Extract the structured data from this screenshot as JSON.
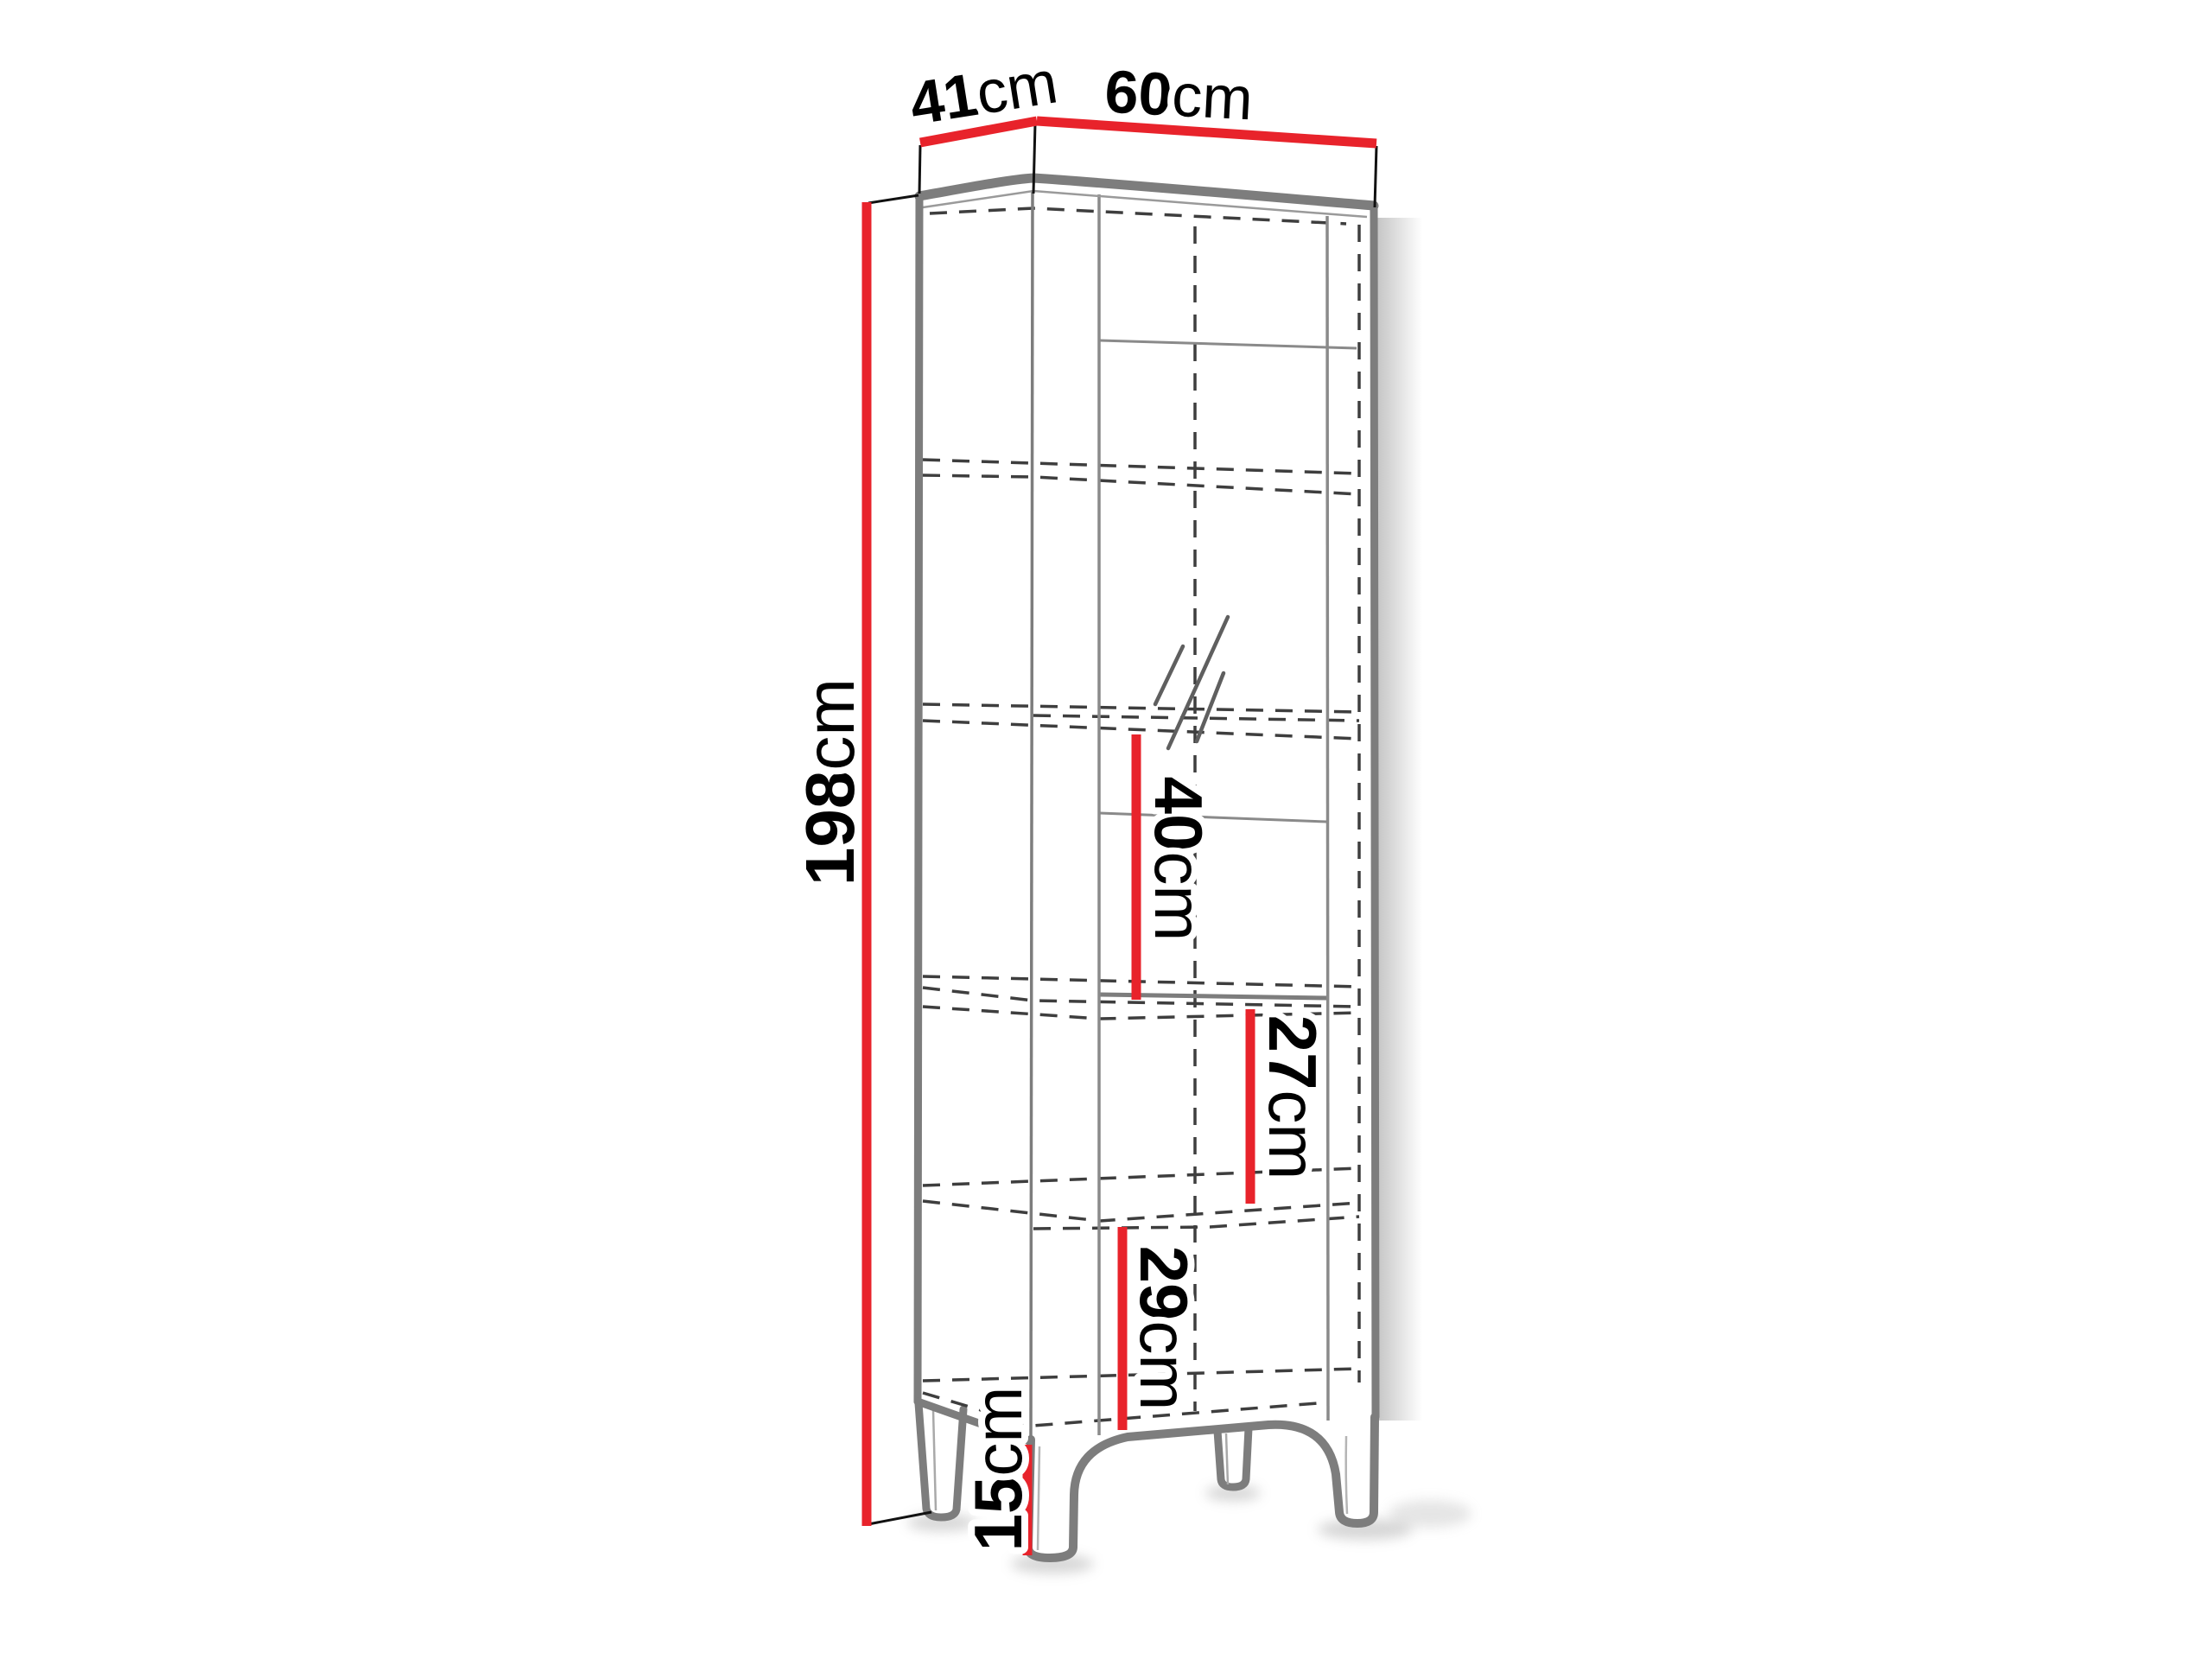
{
  "diagram": {
    "type": "furniture-dimension-diagram",
    "dimensions": {
      "depth": {
        "value": "41",
        "unit": "cm"
      },
      "width": {
        "value": "60",
        "unit": "cm"
      },
      "height": {
        "value": "198",
        "unit": "cm"
      },
      "upper_section": {
        "value": "40",
        "unit": "cm"
      },
      "middle_section": {
        "value": "27",
        "unit": "cm"
      },
      "bottom_section": {
        "value": "29",
        "unit": "cm"
      },
      "leg_height": {
        "value": "15",
        "unit": "cm"
      }
    },
    "colors": {
      "dimension_red": "#e8232b",
      "outline_gray": "#7d7d7d",
      "dashed_gray": "#3e3e3e",
      "text_black": "#000000",
      "background": "#ffffff"
    }
  }
}
